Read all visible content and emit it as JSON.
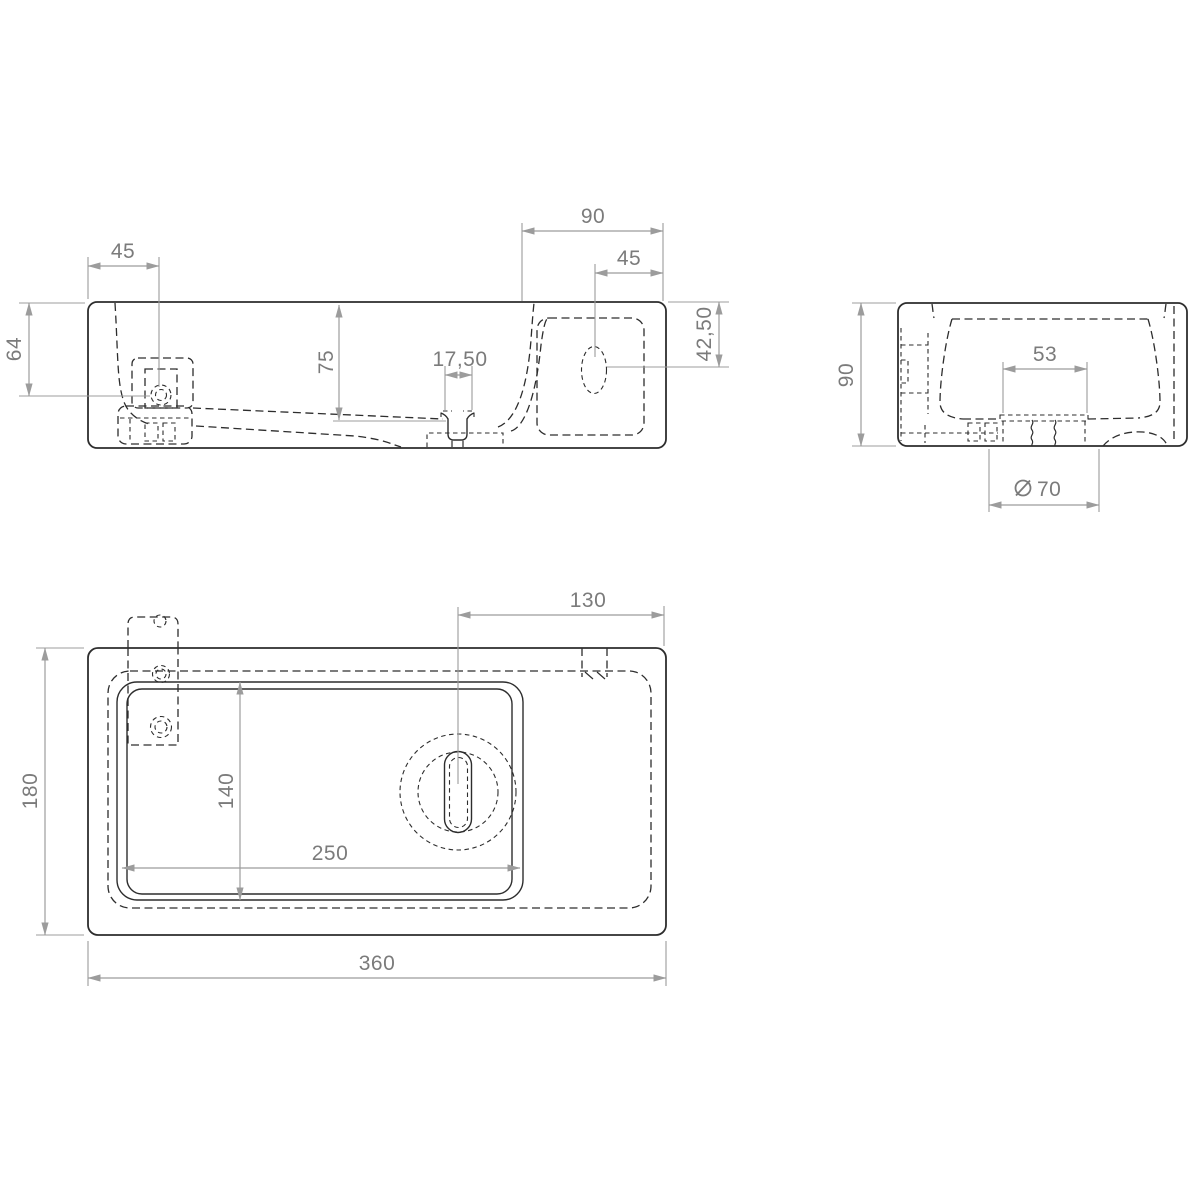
{
  "drawing": {
    "type": "technical-dimension-drawing",
    "subject": "wall-hung washbasin, three orthographic views",
    "colors": {
      "background": "#ffffff",
      "object_line": "#2d2d2d",
      "dimension_line": "#9c9c9c",
      "label_text": "#7b7b7b"
    },
    "views": {
      "front": {
        "name": "front view",
        "dims": {
          "d45_left": "45",
          "d90": "90",
          "d45_right": "45",
          "d64": "64",
          "d75": "75",
          "d17_50": "17,50",
          "d42_50": "42,50"
        }
      },
      "side": {
        "name": "side view",
        "dims": {
          "d90": "90",
          "d53": "53",
          "diameter_symbol": "⌀",
          "d70": "70"
        }
      },
      "plan": {
        "name": "top view",
        "dims": {
          "d130": "130",
          "d180": "180",
          "d140": "140",
          "d250": "250",
          "d360": "360"
        }
      }
    }
  }
}
